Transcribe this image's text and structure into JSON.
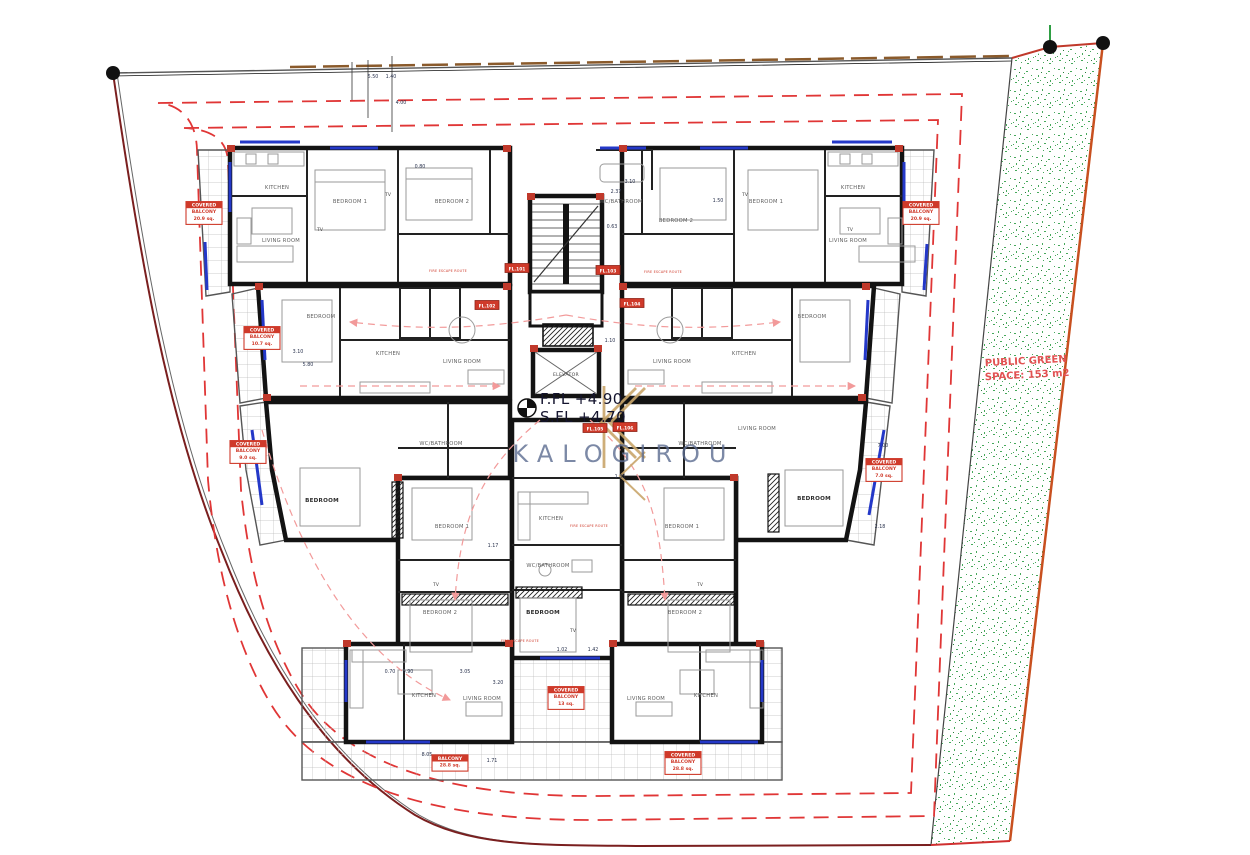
{
  "meta": {
    "watermark": "KALOGIROU"
  },
  "levels": {
    "first_floor": "F.FL +4.90",
    "second_floor": "S.FL +4.70"
  },
  "site": {
    "green_line1": "PUBLIC GREEN",
    "green_line2": "SPACE: 153 m2"
  },
  "core": {
    "elevator": "ELEVATOR"
  },
  "colors": {
    "wall_black": "#131313",
    "annotation_red": "#cf3a2a",
    "setback_red": "#e03636",
    "window_blue": "#2438c8",
    "green_dots": "#33a04a",
    "boundary_orange": "#c8501f",
    "watermark_blue": "#5c6c90",
    "logo_gold": "#c9a66b"
  },
  "room_labels": [
    {
      "text": "KITCHEN",
      "x": 277,
      "y": 189
    },
    {
      "text": "LIVING ROOM",
      "x": 281,
      "y": 242
    },
    {
      "text": "BEDROOM 1",
      "x": 350,
      "y": 203
    },
    {
      "text": "BEDROOM 2",
      "x": 452,
      "y": 203
    },
    {
      "text": "WC/BATHROOM",
      "x": 621,
      "y": 203
    },
    {
      "text": "BEDROOM 2",
      "x": 676,
      "y": 222
    },
    {
      "text": "BEDROOM 1",
      "x": 766,
      "y": 203
    },
    {
      "text": "KITCHEN",
      "x": 853,
      "y": 189
    },
    {
      "text": "LIVING ROOM",
      "x": 848,
      "y": 242
    },
    {
      "text": "BEDROOM",
      "x": 321,
      "y": 318
    },
    {
      "text": "KITCHEN",
      "x": 388,
      "y": 355
    },
    {
      "text": "LIVING ROOM",
      "x": 462,
      "y": 363
    },
    {
      "text": "LIVING ROOM",
      "x": 672,
      "y": 363
    },
    {
      "text": "KITCHEN",
      "x": 744,
      "y": 355
    },
    {
      "text": "BEDROOM",
      "x": 812,
      "y": 318
    },
    {
      "text": "WC/BATHROOM",
      "x": 441,
      "y": 445
    },
    {
      "text": "LIVING ROOM",
      "x": 757,
      "y": 430
    },
    {
      "text": "WC/BATHROOM",
      "x": 700,
      "y": 445
    },
    {
      "text": "BEDROOM",
      "x": 322,
      "y": 502,
      "bold": true
    },
    {
      "text": "BEDROOM",
      "x": 814,
      "y": 500,
      "bold": true
    },
    {
      "text": "BEDROOM 1",
      "x": 452,
      "y": 528
    },
    {
      "text": "BEDROOM 1",
      "x": 682,
      "y": 528
    },
    {
      "text": "KITCHEN",
      "x": 551,
      "y": 520
    },
    {
      "text": "WC/BATHROOM",
      "x": 548,
      "y": 567
    },
    {
      "text": "BEDROOM",
      "x": 543,
      "y": 614,
      "bold": true
    },
    {
      "text": "BEDROOM 2",
      "x": 440,
      "y": 614
    },
    {
      "text": "BEDROOM 2",
      "x": 685,
      "y": 614
    },
    {
      "text": "KITCHEN",
      "x": 424,
      "y": 697
    },
    {
      "text": "LIVING ROOM",
      "x": 482,
      "y": 700
    },
    {
      "text": "LIVING ROOM",
      "x": 646,
      "y": 700
    },
    {
      "text": "KITCHEN",
      "x": 706,
      "y": 697
    }
  ],
  "tv_labels": [
    {
      "text": "TV",
      "x": 388,
      "y": 196
    },
    {
      "text": "TV",
      "x": 745,
      "y": 196
    },
    {
      "text": "TV",
      "x": 320,
      "y": 231
    },
    {
      "text": "TV",
      "x": 850,
      "y": 231
    },
    {
      "text": "TV",
      "x": 436,
      "y": 586
    },
    {
      "text": "TV",
      "x": 700,
      "y": 586
    },
    {
      "text": "TV",
      "x": 573,
      "y": 632
    }
  ],
  "dimensions": [
    {
      "t": "5.50",
      "x": 373,
      "y": 78
    },
    {
      "t": "1.40",
      "x": 391,
      "y": 78
    },
    {
      "t": "4.00",
      "x": 401,
      "y": 104
    },
    {
      "t": "0.80",
      "x": 420,
      "y": 168
    },
    {
      "t": "3.10",
      "x": 630,
      "y": 183
    },
    {
      "t": "2.37",
      "x": 616,
      "y": 193
    },
    {
      "t": "1.50",
      "x": 718,
      "y": 202
    },
    {
      "t": "0.63",
      "x": 612,
      "y": 228
    },
    {
      "t": "1.10",
      "x": 610,
      "y": 342
    },
    {
      "t": "3.10",
      "x": 298,
      "y": 353
    },
    {
      "t": "5.80",
      "x": 308,
      "y": 366
    },
    {
      "t": "7.00",
      "x": 883,
      "y": 447
    },
    {
      "t": "1.35",
      "x": 620,
      "y": 478
    },
    {
      "t": "1.17",
      "x": 493,
      "y": 547
    },
    {
      "t": "2.18",
      "x": 880,
      "y": 528
    },
    {
      "t": "0.70",
      "x": 390,
      "y": 673
    },
    {
      "t": "0.90",
      "x": 408,
      "y": 673
    },
    {
      "t": "3.05",
      "x": 465,
      "y": 673
    },
    {
      "t": "1.02",
      "x": 562,
      "y": 651
    },
    {
      "t": "1.42",
      "x": 593,
      "y": 651
    },
    {
      "t": "3.20",
      "x": 498,
      "y": 684
    },
    {
      "t": "1.71",
      "x": 492,
      "y": 762
    },
    {
      "t": "8.05",
      "x": 427,
      "y": 756
    }
  ],
  "unit_tags": [
    {
      "text": "FL.101",
      "x": 517,
      "y": 268
    },
    {
      "text": "FL.102",
      "x": 487,
      "y": 305
    },
    {
      "text": "FL.103",
      "x": 608,
      "y": 270
    },
    {
      "text": "FL.104",
      "x": 632,
      "y": 303
    },
    {
      "text": "FL.105",
      "x": 595,
      "y": 428
    },
    {
      "text": "FL.106",
      "x": 625,
      "y": 427
    }
  ],
  "balcony_tags": [
    {
      "x": 204,
      "y": 213,
      "lines": [
        "COVERED",
        "BALCONY",
        "20.9 sq."
      ]
    },
    {
      "x": 921,
      "y": 213,
      "lines": [
        "COVERED",
        "BALCONY",
        "20.9 sq."
      ]
    },
    {
      "x": 262,
      "y": 338,
      "lines": [
        "COVERED",
        "BALCONY",
        "10.7 sq."
      ]
    },
    {
      "x": 884,
      "y": 470,
      "lines": [
        "COVERED",
        "BALCONY",
        "7.0 sq."
      ]
    },
    {
      "x": 248,
      "y": 452,
      "lines": [
        "COVERED",
        "BALCONY",
        "9.0 sq."
      ]
    },
    {
      "x": 450,
      "y": 763,
      "lines": [
        "BALCONY",
        "28.8 sq."
      ]
    },
    {
      "x": 566,
      "y": 698,
      "lines": [
        "COVERED",
        "BALCONY",
        "13 sq."
      ]
    },
    {
      "x": 683,
      "y": 763,
      "lines": [
        "COVERED",
        "BALCONY",
        "28.8 sq."
      ]
    }
  ],
  "route_notes": [
    {
      "text": "FIRE ESCAPE ROUTE",
      "x": 448,
      "y": 272
    },
    {
      "text": "FIRE ESCAPE ROUTE",
      "x": 663,
      "y": 273
    },
    {
      "text": "FIRE ESCAPE ROUTE",
      "x": 589,
      "y": 527
    },
    {
      "text": "FIRE ESCAPE ROUTE",
      "x": 520,
      "y": 642
    }
  ]
}
